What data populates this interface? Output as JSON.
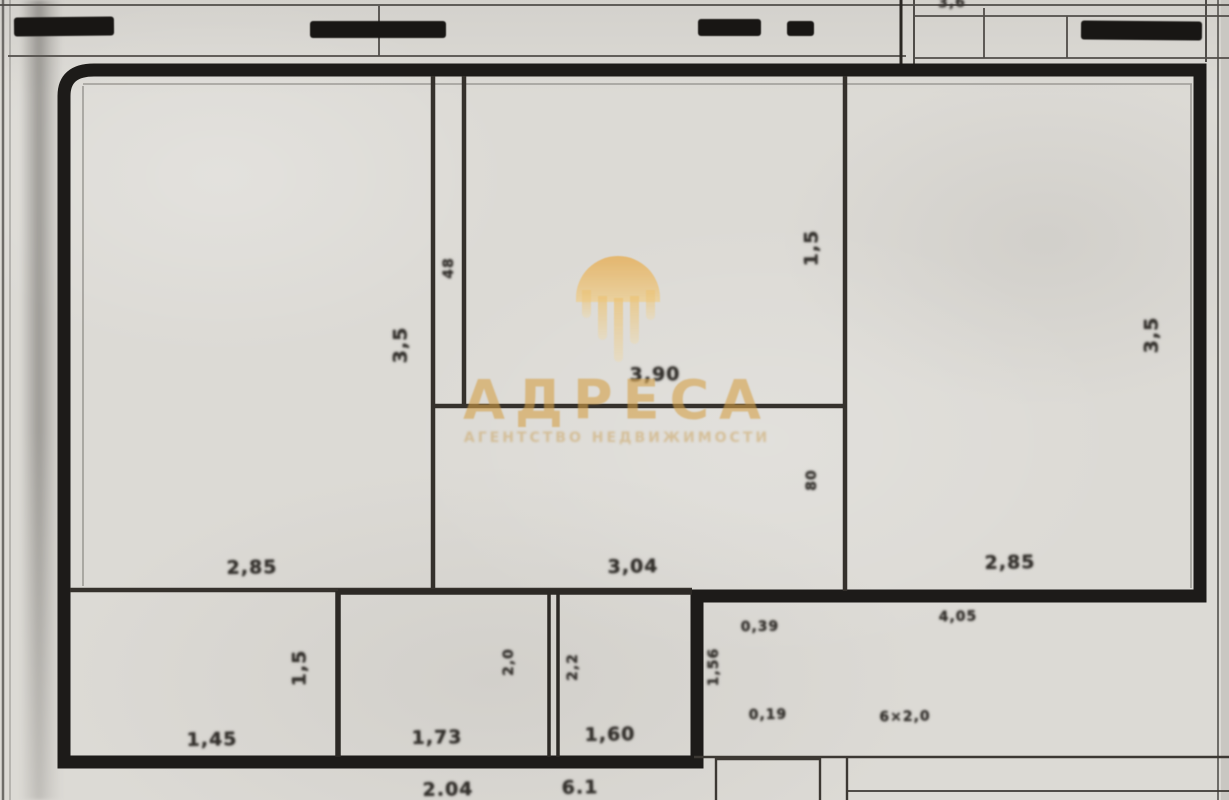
{
  "watermark": {
    "brand": "АДРЕСА",
    "tagline": "АГЕНТСТВО НЕДВИЖИМОСТИ",
    "logo": "gold-dome-strands-icon",
    "brand_color": "#d3a048"
  },
  "colors": {
    "paper": "#dcdad5",
    "outer_wall": "#1d1b19",
    "interior_wall": "#35312c",
    "dimension_text": "#33302c",
    "watermark_gold": "#d3a048"
  },
  "dim_labels": [
    {
      "text": "3,5",
      "x": 401,
      "y": 345,
      "rot": true,
      "small": false
    },
    {
      "text": "48",
      "x": 449,
      "y": 268,
      "rot": true,
      "small": true
    },
    {
      "text": "3,90",
      "x": 655,
      "y": 375,
      "rot": false,
      "small": false
    },
    {
      "text": "1,5",
      "x": 812,
      "y": 248,
      "rot": true,
      "small": false
    },
    {
      "text": "80",
      "x": 812,
      "y": 480,
      "rot": true,
      "small": true
    },
    {
      "text": "3,5",
      "x": 1152,
      "y": 335,
      "rot": true,
      "small": false
    },
    {
      "text": "2,85",
      "x": 252,
      "y": 568,
      "rot": false,
      "small": false
    },
    {
      "text": "3,04",
      "x": 633,
      "y": 567,
      "rot": false,
      "small": false
    },
    {
      "text": "2,85",
      "x": 1010,
      "y": 563,
      "rot": false,
      "small": false
    },
    {
      "text": "0,39",
      "x": 760,
      "y": 627,
      "rot": false,
      "small": true
    },
    {
      "text": "4,05",
      "x": 958,
      "y": 617,
      "rot": false,
      "small": true
    },
    {
      "text": "1,5",
      "x": 300,
      "y": 668,
      "rot": true,
      "small": false
    },
    {
      "text": "2,0",
      "x": 509,
      "y": 662,
      "rot": true,
      "small": true
    },
    {
      "text": "2,2",
      "x": 573,
      "y": 667,
      "rot": true,
      "small": true
    },
    {
      "text": "1,56",
      "x": 714,
      "y": 667,
      "rot": true,
      "small": true
    },
    {
      "text": "1,45",
      "x": 212,
      "y": 740,
      "rot": false,
      "small": false
    },
    {
      "text": "1,73",
      "x": 437,
      "y": 738,
      "rot": false,
      "small": false
    },
    {
      "text": "1,60",
      "x": 610,
      "y": 735,
      "rot": false,
      "small": false
    },
    {
      "text": "0,19",
      "x": 768,
      "y": 715,
      "rot": false,
      "small": true
    },
    {
      "text": "6×2,0",
      "x": 905,
      "y": 717,
      "rot": false,
      "small": true
    },
    {
      "text": "3,6",
      "x": 952,
      "y": 3,
      "rot": false,
      "small": true
    },
    {
      "text": "2.04",
      "x": 448,
      "y": 790,
      "rot": false,
      "small": false
    },
    {
      "text": "6.1",
      "x": 580,
      "y": 788,
      "rot": false,
      "small": false
    }
  ]
}
